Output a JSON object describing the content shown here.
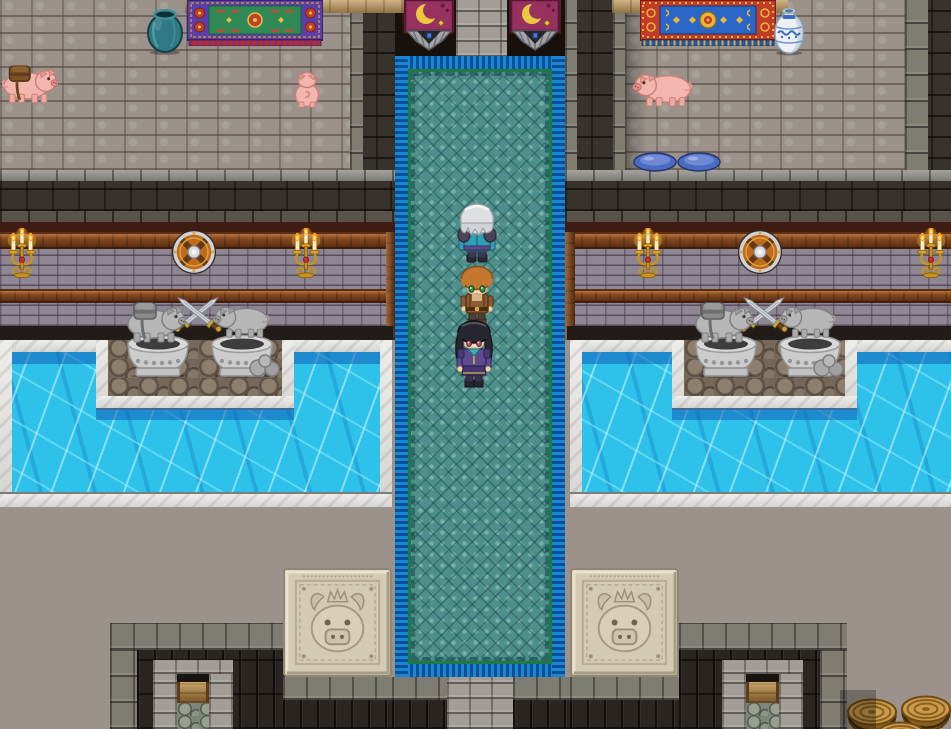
{
  "app": {
    "name": "rpg-castle-interior",
    "type": "game-screenshot",
    "description": "Top-down RPG castle hall: a party of three stands on a teal carpet corridor flanked by water pools, pig statues, crescent-moon banners and pig-crest floor tiles",
    "visible_text": "none"
  },
  "palette": {
    "floor_stone": "#9b938b",
    "dark_wall": "#38322d",
    "brick_wall": "#8e8692",
    "wood_beam": "#8a4a1e",
    "carpet_teal": "#4f8f8b",
    "carpet_border_blue": "#1a86d8",
    "carpet_trim_green": "#1e7a3e",
    "water_cyan": "#2ec2ea",
    "pool_marble": "#e8e7e3",
    "banner_magenta": "#963160",
    "crescent_gold": "#ecc83e",
    "pig_pink": "#f3b6ae",
    "statue_gray": "#b6b6b6",
    "emblem_stone": "#d3cab2",
    "candelabra_gold": "#c8921c"
  },
  "party": [
    {
      "label": "silver-haired elder facing away in teal robes",
      "slot": "front"
    },
    {
      "label": "orange-haired adventurer with green eyes facing camera",
      "slot": "middle"
    },
    {
      "label": "black-haired mage with rose eyes in purple coat facing camera",
      "slot": "rear"
    }
  ],
  "creatures": [
    {
      "label": "pig with brown saddlebags",
      "location": "upper-left floor"
    },
    {
      "label": "piglet seen from behind",
      "location": "upper-left floor"
    },
    {
      "label": "pig walking left",
      "location": "upper-right room"
    }
  ],
  "labels": {
    "scene": "castle hall with pig statues and teal carpet",
    "carpet": "teal ceremonial carpet corridor",
    "pool_left": "left water pool with marble edge",
    "pool_right": "right water pool with marble edge",
    "char_silver": "silver-haired party leader facing away",
    "char_orange": "orange-haired adventurer facing camera",
    "char_black": "black-haired mage facing camera",
    "pig_saddle": "pig with saddlebags",
    "pig_rear": "piglet seen from behind",
    "pig_room": "pig in side room",
    "banner": "crescent moon banner",
    "tapestry_left": "green and purple ornamental tapestry",
    "tapestry_right": "blue and red ornamental tapestry",
    "vase_teal": "teal clay pot",
    "vase_blue": "blue porcelain vase",
    "bowl": "blue feeding bowl",
    "candelabra": "gold wall candelabra with lit candles",
    "shield": "round wooden wall shield",
    "swords": "crossed swords wall mount",
    "statue_pack": "stone pig statue with pack",
    "statue": "stone pig statue",
    "pedestal": "ornate stone pedestal",
    "rocks": "rock pile",
    "emblem": "carved crowned-pig crest tile",
    "barrel": "wooden barrel",
    "bench": "alcove bench",
    "pillar": "stone pillar",
    "alcove": "sunken stair alcove"
  }
}
